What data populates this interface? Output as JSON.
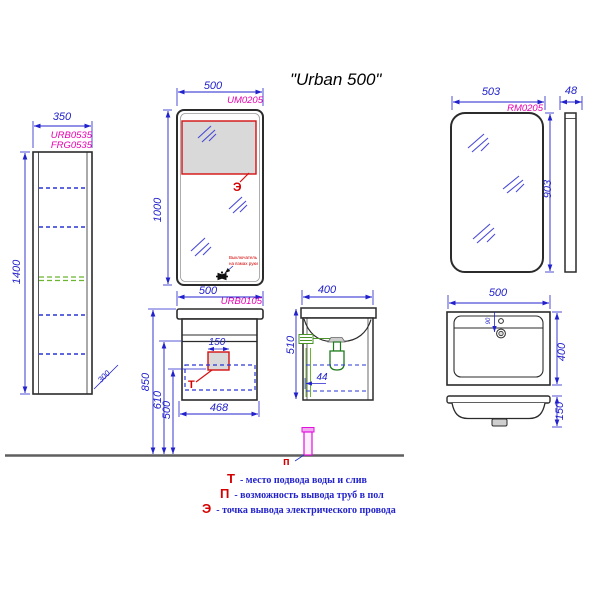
{
  "title": "\"Urban 500\"",
  "tall_cabinet": {
    "code_line1": "URB0535",
    "code_line2": "FRG0535",
    "width": "350",
    "height": "1400",
    "depth": "300"
  },
  "mirror_front": {
    "code": "UM0205",
    "width": "500",
    "height": "1000",
    "electric_label": "Э",
    "sensor_note_line1": "Выключатель",
    "sensor_note_line2": "на взмах руки"
  },
  "vanity": {
    "code": "URB0105",
    "top_width": "500",
    "cutout_width": "150",
    "height_total": "850",
    "height_drain": "610",
    "height_bottom": "500",
    "body_width": "468",
    "water_label": "Т"
  },
  "vanity_side": {
    "depth": "400",
    "height": "510",
    "pipe_offset": "44"
  },
  "mirror_right": {
    "code": "RM0205",
    "width": "503",
    "height": "903",
    "depth": "48"
  },
  "basin": {
    "width": "500",
    "depth": "400",
    "apron_height": "150",
    "faucet_offset": "90"
  },
  "floor_pipe_label": "п",
  "legend": {
    "rows": [
      {
        "symbol": "Т",
        "text": "- место подвода воды и слив"
      },
      {
        "symbol": "П",
        "text": "- возможность вывода труб в пол"
      },
      {
        "symbol": "Э",
        "text": "- точка вывода электрического провода"
      }
    ]
  },
  "colors": {
    "dimension_blue": "#2222cc",
    "code_magenta": "#e800b0",
    "marker_red": "#d40000",
    "shelf_green": "#6cb52e",
    "pipe_magenta": "#e011dd"
  }
}
